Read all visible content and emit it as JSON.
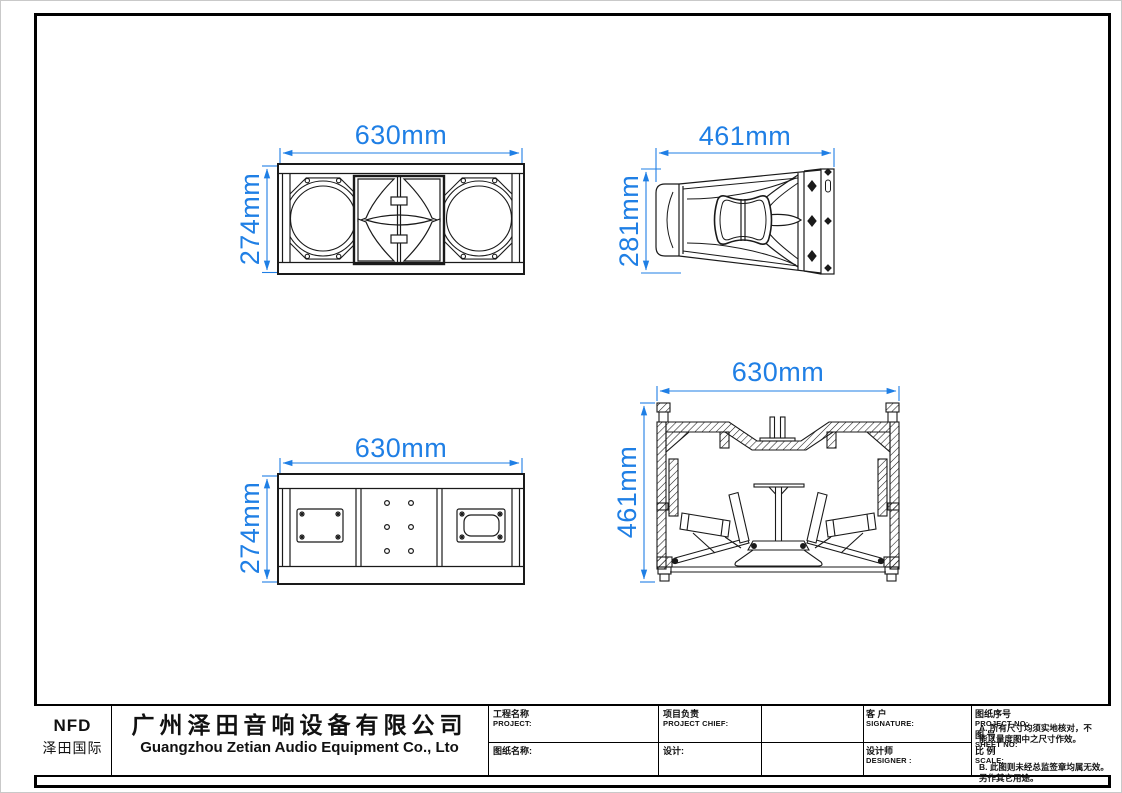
{
  "colors": {
    "dimension_blue": "#1f7fe5",
    "line_black": "#1a1a1a"
  },
  "views": {
    "front": {
      "label": "front view (dual woofers and horn)",
      "width": "630mm",
      "height": "274mm"
    },
    "side": {
      "label": "side view (rigging plate)",
      "width": "461mm",
      "height": "281mm"
    },
    "rear": {
      "label": "rear view (connector panels)",
      "width": "630mm",
      "height": "274mm"
    },
    "section": {
      "label": "section view (internal structure)",
      "width": "630mm",
      "height": "461mm"
    }
  },
  "title_block": {
    "logo": {
      "line1": "NFD",
      "line2": "泽田国际"
    },
    "company": {
      "cn": "广州泽田音响设备有限公司",
      "en": "Guangzhou Zetian Audio Equipment Co., Lto"
    },
    "fields": {
      "project_cn": "工程名称",
      "project_en": "PROJECT:",
      "chief_cn": "项目负责",
      "chief_en": "PROJECT CHIEF:",
      "signature_cn": "客 户",
      "signature_en": "SIGNATURE:",
      "drawing_no_cn": "图纸序号",
      "drawing_no_en": "PROJECT NO:",
      "sheet_cn": "图  号",
      "sheet_en": "SHEET  NO:",
      "drawing_name_cn": "图纸名称:",
      "design_cn": "设计:",
      "designer_cn": "设计师",
      "designer_en": "DESIGNER :",
      "scale_cn": "比  例",
      "scale_en": "SCALE:"
    },
    "notes": {
      "a": "A. 所有尺寸均须实地核对，不\n     能以量度图中之尺寸作效。",
      "b": "B. 此图则未经总监签章均属无效。\n     另作其它用途。"
    }
  }
}
